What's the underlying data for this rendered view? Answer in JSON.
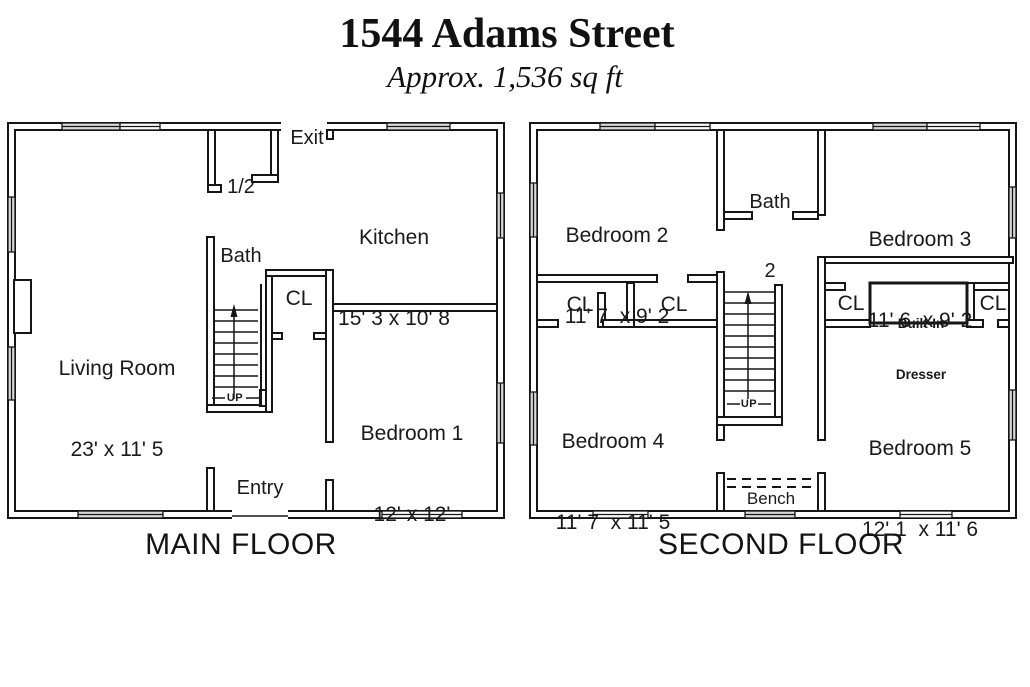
{
  "header": {
    "title": "1544 Adams Street",
    "subtitle": "Approx. 1,536 sq ft"
  },
  "main_floor": {
    "caption": "MAIN FLOOR",
    "half_bath": {
      "line1": "1/2",
      "line2": "Bath"
    },
    "exit_label": "Exit",
    "kitchen": {
      "name": "Kitchen",
      "dims": "15' 3 x 10' 8"
    },
    "living_room": {
      "name": "Living Room",
      "dims": "23' x 11' 5"
    },
    "closet_label": "CL",
    "bedroom1": {
      "name": "Bedroom 1",
      "dims": "12' x 12'"
    },
    "entry_label": "Entry",
    "stairs_label": "UP"
  },
  "second_floor": {
    "caption": "SECOND FLOOR",
    "bedroom2": {
      "name": "Bedroom 2",
      "dims": "11' 7  x 9' 2"
    },
    "bath2": {
      "line1": "Bath",
      "line2": "2"
    },
    "bedroom3": {
      "name": "Bedroom 3",
      "dims": "11' 6  x 9' 2"
    },
    "bedroom4": {
      "name": "Bedroom 4",
      "dims": "11' 7  x 11' 5"
    },
    "bedroom5": {
      "name": "Bedroom 5",
      "dims": "12' 1  x 11' 6"
    },
    "closet_left_a": "CL",
    "closet_left_b": "CL",
    "closet_right_a": "CL",
    "closet_right_b": "CL",
    "dresser": {
      "line1": "Built-In",
      "line2": "Dresser"
    },
    "bench_label": "Bench",
    "stairs_label": "UP"
  }
}
